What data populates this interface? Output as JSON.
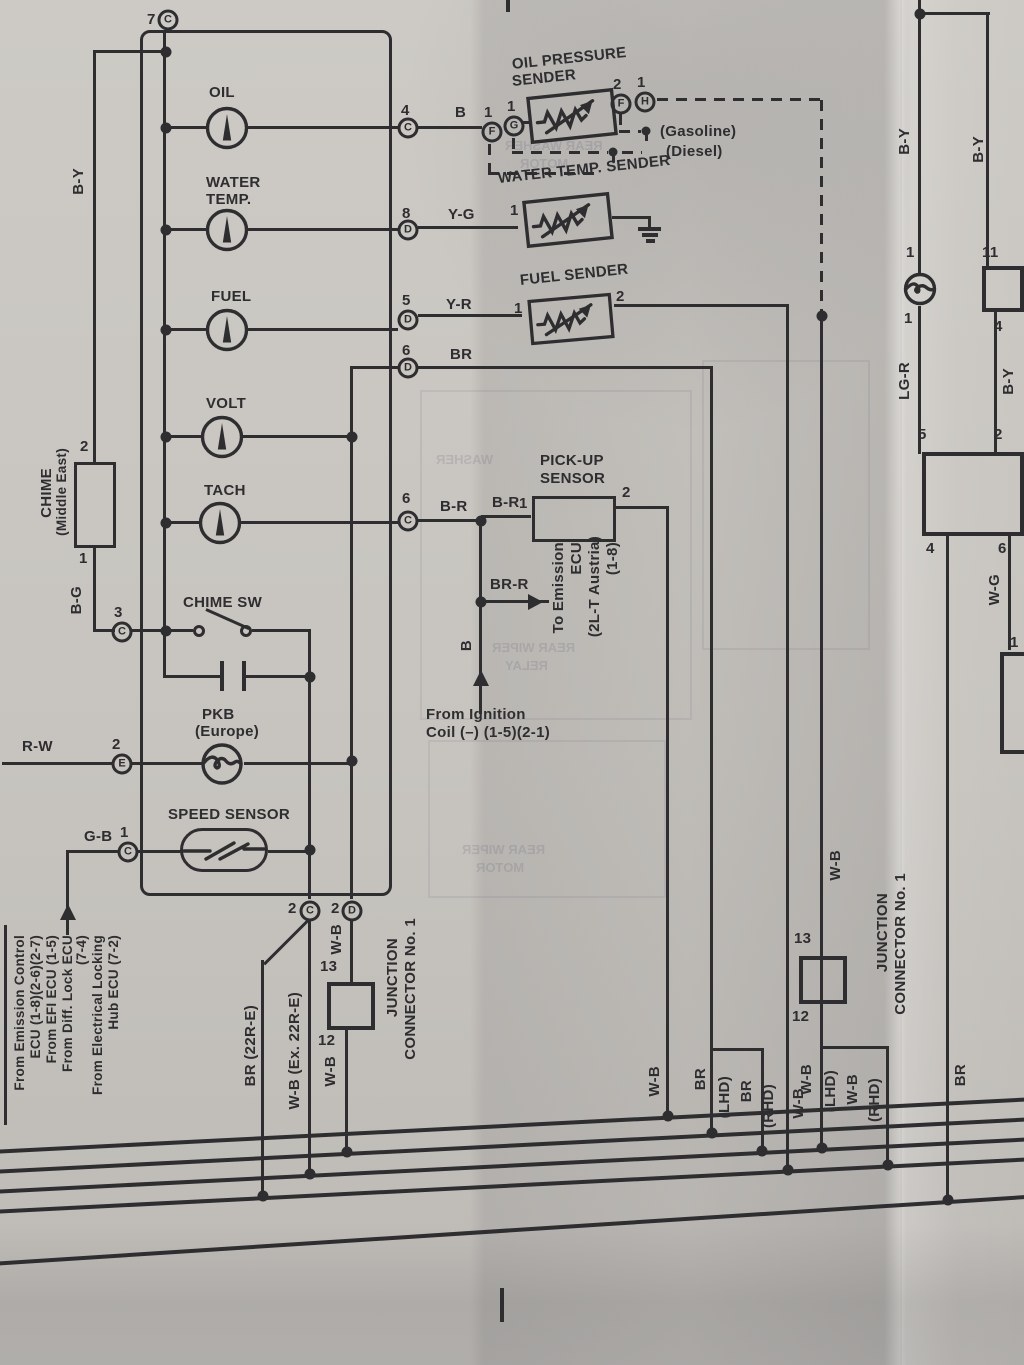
{
  "colors": {
    "ink": "#2e2d30",
    "paper": "#c9c6c1"
  },
  "meter": {
    "pin7": {
      "n": "7",
      "l": "C"
    },
    "oil": {
      "label": "OIL",
      "pin": "4",
      "letter": "C",
      "wire": "B"
    },
    "water": {
      "l1": "WATER",
      "l2": "TEMP.",
      "pin": "8",
      "letter": "D",
      "wire": "Y-G"
    },
    "fuel": {
      "label": "FUEL",
      "pin": "5",
      "letter": "D",
      "wire": "Y-R"
    },
    "br_row": {
      "pin": "6",
      "letter": "D",
      "wire": "BR"
    },
    "volt": {
      "label": "VOLT"
    },
    "tach": {
      "label": "TACH",
      "pin": "6",
      "letter": "C",
      "wire": "B-R",
      "wire2": "B-R"
    },
    "chime_sw": {
      "label": "CHIME SW",
      "pin": "3",
      "letter": "C"
    },
    "pkb": {
      "l1": "PKB",
      "l2": "(Europe)",
      "pin": "2",
      "letter": "E",
      "wire": "R-W"
    },
    "speed": {
      "label": "SPEED SENSOR",
      "pin": "1",
      "letter": "C",
      "wire": "G-B"
    },
    "out_c": {
      "n": "2",
      "l": "C"
    },
    "out_d": {
      "n": "2",
      "l": "D"
    }
  },
  "chime": {
    "l1": "CHIME",
    "l2": "(Middle East)",
    "pin_top": "2",
    "pin_bot": "1",
    "wire_top": "B-Y",
    "wire_bot": "B-G"
  },
  "oil_sender": {
    "l1": "OIL PRESSURE",
    "l2": "SENDER",
    "pl1n": "1",
    "pl1l": "F",
    "pl2n": "1",
    "pl2l": "G",
    "pr1n": "2",
    "pr1l": "F",
    "pr2n": "1",
    "pr2l": "H",
    "gasoline": "(Gasoline)",
    "diesel": "(Diesel)"
  },
  "water_sender": {
    "label": "WATER TEMP. SENDER",
    "pin": "1"
  },
  "fuel_sender": {
    "label": "FUEL SENDER",
    "p1": "1",
    "p2": "2",
    "wire": "W-B"
  },
  "pickup": {
    "l1": "PICK-UP",
    "l2": "SENSOR",
    "p1": "1",
    "p2": "2"
  },
  "ign": {
    "brr": "BR-R",
    "b": "B",
    "to1": "To Emission",
    "to2": "ECU",
    "to3": "(2L-T Austria)",
    "to4": "(1-8)",
    "f1": "From Ignition",
    "f2": "Coil (–) (1-5)(2-1)"
  },
  "left_block": {
    "c1": "From Emission Control",
    "c2": "ECU (1-8)(2-6)(2-7)",
    "c3": "From EFI ECU (1-5)",
    "c4": "From Diff. Lock ECU",
    "c5": "(7-4)",
    "c6": "From Electrical Locking",
    "c7": "Hub ECU (7-2)"
  },
  "jc_left": {
    "wire_in": "W-B",
    "p13": "13",
    "p12": "12",
    "wire_out": "W-B",
    "l1": "JUNCTION",
    "l2": "CONNECTOR No. 1",
    "br22": "BR (22R-E)",
    "wbex": "W-B (Ex. 22R-E)"
  },
  "jc_right": {
    "wire_in": "W-B",
    "p13": "13",
    "p12": "12",
    "l1": "JUNCTION",
    "l2": "CONNECTOR No. 1",
    "wb": "W-B",
    "lhd": "(LHD)",
    "wb2": "W-B",
    "rhd": "(RHD)"
  },
  "mid_drops": {
    "wb": "W-B",
    "br": "BR",
    "lhd": "(LHD)",
    "br2": "BR",
    "rhd": "(RHD)",
    "wb2": "W-B"
  },
  "right": {
    "by1": "B-Y",
    "by2": "B-Y",
    "p1a": "1",
    "p1b": "1",
    "lgr": "LG-R",
    "p11": "11",
    "p4a": "4",
    "by3": "B-Y",
    "p5": "5",
    "p2": "2",
    "p4b": "4",
    "p6": "6",
    "wg": "W-G",
    "p1c": "1",
    "br": "BR"
  },
  "ghost": {
    "g1a": "REAR WASHER",
    "g1b": "MOTOR",
    "g2a": "REAR WIPER",
    "g2b": "RELAY",
    "g3a": "REAR WIPER",
    "g3b": "MOTOR",
    "g4": "WASHER"
  }
}
